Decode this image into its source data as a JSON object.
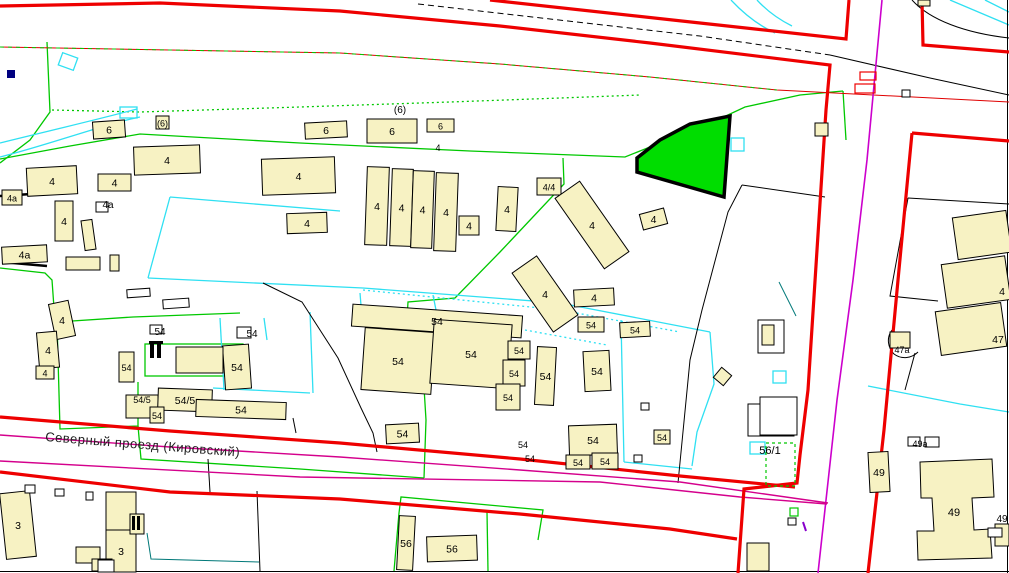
{
  "map": {
    "street_label": "Северный проезд (Кировский)",
    "highlight_parcel": {
      "fill": "#00dd00",
      "outline": "#000000"
    },
    "colors": {
      "quarter_boundary_red": "#ee0000",
      "parcel_cyan": "#2fe0f2",
      "landuse_green": "#00c800",
      "road_axis_magenta": "#cc00cc",
      "road_axis_pink": "#d4008c",
      "building_fill": "#f7f2c3"
    },
    "buildings": [
      {
        "x": 93,
        "y": 121,
        "w": 32,
        "h": 17,
        "r": -4,
        "label": "6"
      },
      {
        "x": 156,
        "y": 116,
        "w": 13,
        "h": 13,
        "r": 0,
        "label": "(6)",
        "fs": 9
      },
      {
        "x": 305,
        "y": 122,
        "w": 42,
        "h": 16,
        "r": -3,
        "label": "6"
      },
      {
        "x": 367,
        "y": 119,
        "w": 50,
        "h": 24,
        "r": 0,
        "label": "6"
      },
      {
        "x": 427,
        "y": 119,
        "w": 27,
        "h": 13,
        "r": 0,
        "label": "6",
        "fs": 9
      },
      {
        "x": 27,
        "y": 167,
        "w": 50,
        "h": 28,
        "r": -3,
        "label": "4"
      },
      {
        "x": 2,
        "y": 190,
        "w": 20,
        "h": 15,
        "r": 0,
        "label": "4а",
        "fs": 9
      },
      {
        "x": 98,
        "y": 174,
        "w": 33,
        "h": 17,
        "r": 0,
        "label": "4"
      },
      {
        "x": 55,
        "y": 201,
        "w": 18,
        "h": 40,
        "r": 0,
        "label": "4"
      },
      {
        "x": 83,
        "y": 220,
        "w": 11,
        "h": 30,
        "r": -8,
        "label": ""
      },
      {
        "x": 2,
        "y": 246,
        "w": 45,
        "h": 17,
        "r": -3,
        "label": "4а"
      },
      {
        "x": 66,
        "y": 257,
        "w": 34,
        "h": 13,
        "r": 0,
        "label": ""
      },
      {
        "x": 110,
        "y": 255,
        "w": 9,
        "h": 16,
        "r": 0,
        "label": ""
      },
      {
        "x": 134,
        "y": 146,
        "w": 66,
        "h": 28,
        "r": -2,
        "label": "4"
      },
      {
        "x": 262,
        "y": 158,
        "w": 73,
        "h": 36,
        "r": -2,
        "label": "4"
      },
      {
        "x": 287,
        "y": 213,
        "w": 40,
        "h": 20,
        "r": -2,
        "label": "4"
      },
      {
        "x": 366,
        "y": 167,
        "w": 22,
        "h": 78,
        "r": 2,
        "label": "4"
      },
      {
        "x": 391,
        "y": 169,
        "w": 21,
        "h": 77,
        "r": 2,
        "label": "4"
      },
      {
        "x": 412,
        "y": 171,
        "w": 21,
        "h": 77,
        "r": 2,
        "label": "4"
      },
      {
        "x": 435,
        "y": 173,
        "w": 22,
        "h": 78,
        "r": 2,
        "label": "4"
      },
      {
        "x": 459,
        "y": 216,
        "w": 20,
        "h": 19,
        "r": 0,
        "label": "4"
      },
      {
        "x": 497,
        "y": 187,
        "w": 20,
        "h": 44,
        "r": 3,
        "label": "4"
      },
      {
        "x": 537,
        "y": 178,
        "w": 24,
        "h": 17,
        "r": 0,
        "label": "4/4",
        "fs": 9
      },
      {
        "x": 577,
        "y": 182,
        "w": 30,
        "h": 86,
        "r": -35,
        "label": "4"
      },
      {
        "x": 530,
        "y": 258,
        "w": 30,
        "h": 72,
        "r": -35,
        "label": "4"
      },
      {
        "x": 641,
        "y": 211,
        "w": 25,
        "h": 16,
        "r": -15,
        "label": "4"
      },
      {
        "x": 574,
        "y": 289,
        "w": 40,
        "h": 17,
        "r": -3,
        "label": "4"
      },
      {
        "x": 815,
        "y": 123,
        "w": 13,
        "h": 13,
        "r": 0,
        "label": ""
      },
      {
        "x": 918,
        "y": 0,
        "w": 12,
        "h": 6,
        "r": 0,
        "label": ""
      },
      {
        "x": 955,
        "y": 214,
        "w": 54,
        "h": 42,
        "r": -8,
        "label": ""
      },
      {
        "x": 944,
        "y": 260,
        "w": 64,
        "h": 44,
        "r": -8,
        "label": "4",
        "lx": 1002,
        "ly": 291
      },
      {
        "x": 938,
        "y": 307,
        "w": 66,
        "h": 44,
        "r": -8,
        "label": "47",
        "lx": 998,
        "ly": 339
      },
      {
        "x": 890,
        "y": 332,
        "w": 20,
        "h": 16,
        "r": 0,
        "label": ""
      },
      {
        "x": 352,
        "y": 310,
        "w": 170,
        "h": 22,
        "r": 4,
        "label": "54"
      },
      {
        "x": 363,
        "y": 330,
        "w": 70,
        "h": 62,
        "r": 4,
        "label": "54"
      },
      {
        "x": 432,
        "y": 322,
        "w": 78,
        "h": 64,
        "r": 4,
        "label": "54"
      },
      {
        "x": 508,
        "y": 341,
        "w": 22,
        "h": 18,
        "r": 0,
        "label": "54",
        "fs": 9
      },
      {
        "x": 503,
        "y": 360,
        "w": 22,
        "h": 26,
        "r": 0,
        "label": "54",
        "fs": 9
      },
      {
        "x": 496,
        "y": 384,
        "w": 24,
        "h": 26,
        "r": 0,
        "label": "54",
        "fs": 9
      },
      {
        "x": 536,
        "y": 347,
        "w": 19,
        "h": 58,
        "r": 3,
        "label": "54"
      },
      {
        "x": 584,
        "y": 351,
        "w": 26,
        "h": 40,
        "r": -3,
        "label": "54"
      },
      {
        "x": 578,
        "y": 317,
        "w": 26,
        "h": 15,
        "r": 0,
        "label": "54",
        "fs": 9
      },
      {
        "x": 620,
        "y": 322,
        "w": 30,
        "h": 15,
        "r": -3,
        "label": "54",
        "fs": 9
      },
      {
        "x": 224,
        "y": 345,
        "w": 26,
        "h": 44,
        "r": -4,
        "label": "54"
      },
      {
        "x": 176,
        "y": 347,
        "w": 47,
        "h": 26,
        "r": 0,
        "label": ""
      },
      {
        "x": 119,
        "y": 352,
        "w": 15,
        "h": 30,
        "r": 0,
        "label": "54",
        "fs": 9
      },
      {
        "x": 126,
        "y": 395,
        "w": 32,
        "h": 23,
        "r": 0,
        "label": "54/5",
        "fs": 9,
        "ly": 399
      },
      {
        "x": 158,
        "y": 389,
        "w": 54,
        "h": 22,
        "r": 2,
        "label": "54/5"
      },
      {
        "x": 150,
        "y": 407,
        "w": 14,
        "h": 16,
        "r": 0,
        "label": "54",
        "fs": 9
      },
      {
        "x": 196,
        "y": 401,
        "w": 90,
        "h": 17,
        "r": 2,
        "label": "54"
      },
      {
        "x": 386,
        "y": 424,
        "w": 33,
        "h": 19,
        "r": -3,
        "label": "54"
      },
      {
        "x": 569,
        "y": 425,
        "w": 48,
        "h": 30,
        "r": -2,
        "label": "54"
      },
      {
        "x": 566,
        "y": 455,
        "w": 24,
        "h": 14,
        "r": 0,
        "label": "54",
        "fs": 9
      },
      {
        "x": 592,
        "y": 453,
        "w": 26,
        "h": 16,
        "r": 0,
        "label": "54",
        "fs": 9
      },
      {
        "x": 654,
        "y": 430,
        "w": 16,
        "h": 14,
        "r": 0,
        "label": "54",
        "fs": 9
      },
      {
        "x": 3,
        "y": 492,
        "w": 30,
        "h": 66,
        "r": -6,
        "label": "3"
      },
      {
        "x": 106,
        "y": 492,
        "w": 30,
        "h": 38,
        "r": 0,
        "label": ""
      },
      {
        "x": 106,
        "y": 530,
        "w": 30,
        "h": 42,
        "r": 0,
        "label": "3"
      },
      {
        "x": 76,
        "y": 547,
        "w": 24,
        "h": 16,
        "r": 0,
        "label": ""
      },
      {
        "x": 92,
        "y": 559,
        "w": 20,
        "h": 12,
        "r": 0,
        "label": ""
      },
      {
        "x": 130,
        "y": 514,
        "w": 14,
        "h": 20,
        "r": 0,
        "label": ""
      },
      {
        "x": 398,
        "y": 516,
        "w": 16,
        "h": 54,
        "r": 3,
        "label": "56"
      },
      {
        "x": 427,
        "y": 536,
        "w": 50,
        "h": 25,
        "r": -2,
        "label": "56"
      },
      {
        "x": 747,
        "y": 543,
        "w": 22,
        "h": 28,
        "r": 0,
        "label": ""
      },
      {
        "x": 869,
        "y": 452,
        "w": 20,
        "h": 40,
        "r": -3,
        "label": "49"
      },
      {
        "x": 995,
        "y": 524,
        "w": 14,
        "h": 22,
        "r": 0,
        "label": ""
      },
      {
        "x": 716,
        "y": 370,
        "w": 13,
        "h": 13,
        "r": 40,
        "label": ""
      },
      {
        "x": 52,
        "y": 302,
        "w": 20,
        "h": 36,
        "r": -12,
        "label": "4"
      },
      {
        "x": 38,
        "y": 332,
        "w": 20,
        "h": 36,
        "r": -5,
        "label": "4"
      },
      {
        "x": 36,
        "y": 366,
        "w": 18,
        "h": 13,
        "r": 0,
        "label": "4",
        "fs": 9
      }
    ],
    "text_labels": [
      {
        "x": 400,
        "y": 113,
        "text": "(6)",
        "fs": 10
      },
      {
        "x": 108,
        "y": 208,
        "text": "4а",
        "fs": 10
      },
      {
        "x": 438,
        "y": 151,
        "text": "4",
        "fs": 9
      },
      {
        "x": 160,
        "y": 335,
        "text": "54",
        "fs": 10
      },
      {
        "x": 252,
        "y": 337,
        "text": "54",
        "fs": 10
      },
      {
        "x": 523,
        "y": 448,
        "text": "54",
        "fs": 9
      },
      {
        "x": 530,
        "y": 462,
        "text": "54",
        "fs": 9
      },
      {
        "x": 902,
        "y": 353,
        "text": "47а",
        "fs": 9
      },
      {
        "x": 920,
        "y": 447,
        "text": "49а",
        "fs": 9
      },
      {
        "x": 1002,
        "y": 522,
        "text": "49",
        "fs": 10
      },
      {
        "x": 770,
        "y": 454,
        "text": "56/1",
        "fs": 11
      },
      {
        "x": 954,
        "y": 516,
        "text": "49",
        "fs": 11
      }
    ],
    "marks": [
      {
        "t": "w",
        "x": 25,
        "y": 485,
        "w": 10,
        "h": 8
      },
      {
        "t": "w",
        "x": 55,
        "y": 489,
        "w": 9,
        "h": 7
      },
      {
        "t": "w",
        "x": 86,
        "y": 492,
        "w": 7,
        "h": 8
      },
      {
        "t": "w",
        "x": 127,
        "y": 289,
        "w": 23,
        "h": 8,
        "r": -4
      },
      {
        "t": "w",
        "x": 163,
        "y": 299,
        "w": 26,
        "h": 9,
        "r": -4
      },
      {
        "t": "w",
        "x": 641,
        "y": 403,
        "w": 8,
        "h": 7
      },
      {
        "t": "w",
        "x": 634,
        "y": 455,
        "w": 8,
        "h": 7
      },
      {
        "t": "w",
        "x": 788,
        "y": 518,
        "w": 8,
        "h": 7
      },
      {
        "t": "w",
        "x": 902,
        "y": 90,
        "w": 8,
        "h": 7
      },
      {
        "t": "w",
        "x": 908,
        "y": 437,
        "w": 12,
        "h": 9
      },
      {
        "t": "w",
        "x": 925,
        "y": 437,
        "w": 14,
        "h": 10
      },
      {
        "t": "w",
        "x": 988,
        "y": 528,
        "w": 14,
        "h": 9
      },
      {
        "t": "w",
        "x": 150,
        "y": 325,
        "w": 12,
        "h": 9
      },
      {
        "t": "w",
        "x": 237,
        "y": 327,
        "w": 14,
        "h": 11
      },
      {
        "t": "w",
        "x": 96,
        "y": 202,
        "w": 12,
        "h": 10
      },
      {
        "t": "w",
        "x": 748,
        "y": 404,
        "w": 46,
        "h": 32
      },
      {
        "t": "w",
        "x": 760,
        "y": 397,
        "w": 37,
        "h": 38
      },
      {
        "t": "w",
        "x": 758,
        "y": 320,
        "w": 26,
        "h": 33
      },
      {
        "t": "b",
        "x": 762,
        "y": 325,
        "w": 12,
        "h": 20
      },
      {
        "t": "w",
        "x": 98,
        "y": 560,
        "w": 16,
        "h": 12
      },
      {
        "t": "rO",
        "x": 860,
        "y": 72,
        "w": 16,
        "h": 8
      },
      {
        "t": "rO",
        "x": 855,
        "y": 84,
        "w": 20,
        "h": 9
      },
      {
        "t": "cO",
        "x": 731,
        "y": 138,
        "w": 13,
        "h": 13
      },
      {
        "t": "cO",
        "x": 750,
        "y": 442,
        "w": 15,
        "h": 12
      },
      {
        "t": "cO",
        "x": 773,
        "y": 371,
        "w": 13,
        "h": 12
      },
      {
        "t": "cO",
        "x": 120,
        "y": 107,
        "w": 17,
        "h": 11
      },
      {
        "t": "cO",
        "x": 60,
        "y": 55,
        "w": 16,
        "h": 13,
        "r": 20
      },
      {
        "t": "gD",
        "x": 766,
        "y": 443,
        "w": 29,
        "h": 43
      },
      {
        "t": "gO",
        "x": 790,
        "y": 508,
        "w": 8,
        "h": 8
      },
      {
        "t": "navy",
        "x": 7,
        "y": 70,
        "w": 8,
        "h": 8
      },
      {
        "t": "blk",
        "x": 150,
        "y": 344,
        "w": 4,
        "h": 14
      },
      {
        "t": "blk",
        "x": 157,
        "y": 344,
        "w": 4,
        "h": 14
      },
      {
        "t": "blk",
        "x": 149,
        "y": 341,
        "w": 14,
        "h": 3
      },
      {
        "t": "blk",
        "x": 132,
        "y": 516,
        "w": 3,
        "h": 14
      },
      {
        "t": "blk",
        "x": 137,
        "y": 516,
        "w": 3,
        "h": 14
      }
    ]
  }
}
